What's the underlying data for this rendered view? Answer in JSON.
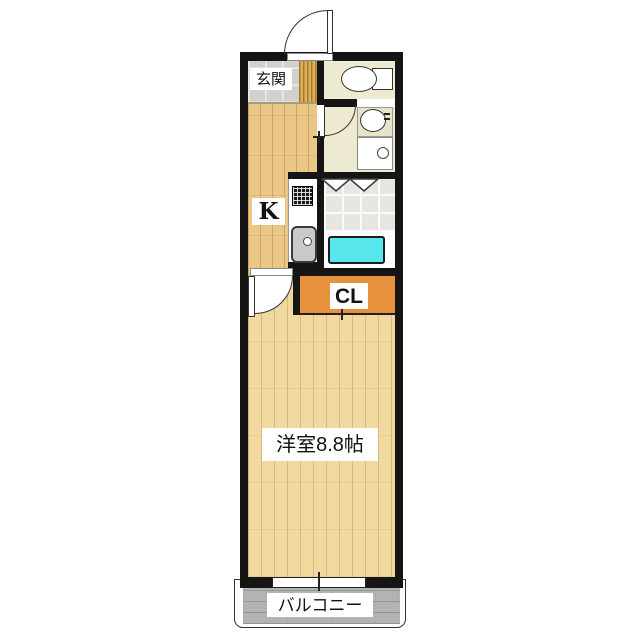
{
  "plan": {
    "labels": {
      "genkan": "玄関",
      "kitchen": "K",
      "closet": "CL",
      "main_room": "洋室8.8帖",
      "balcony": "バルコニー"
    },
    "main_room_size_jo": "8.8",
    "fixtures": [
      "entrance-door",
      "toilet",
      "wash-basin",
      "washing-machine-pan",
      "bathtub",
      "folding-bath-door",
      "kitchen-stove",
      "kitchen-sink",
      "room-door",
      "closet-sliding-door",
      "balcony-window"
    ],
    "colors": {
      "wall": "#151515",
      "wood_room": "#f1d9a0",
      "wood_kitchen": "#eac687",
      "genkan_tile": "#d2d0cc",
      "washroom_floor": "#edead1",
      "bath_tile": "#e8e6e0",
      "bathtub": "#57e6ec",
      "closet": "#e8913d",
      "balcony": "#b3b3b3"
    }
  }
}
